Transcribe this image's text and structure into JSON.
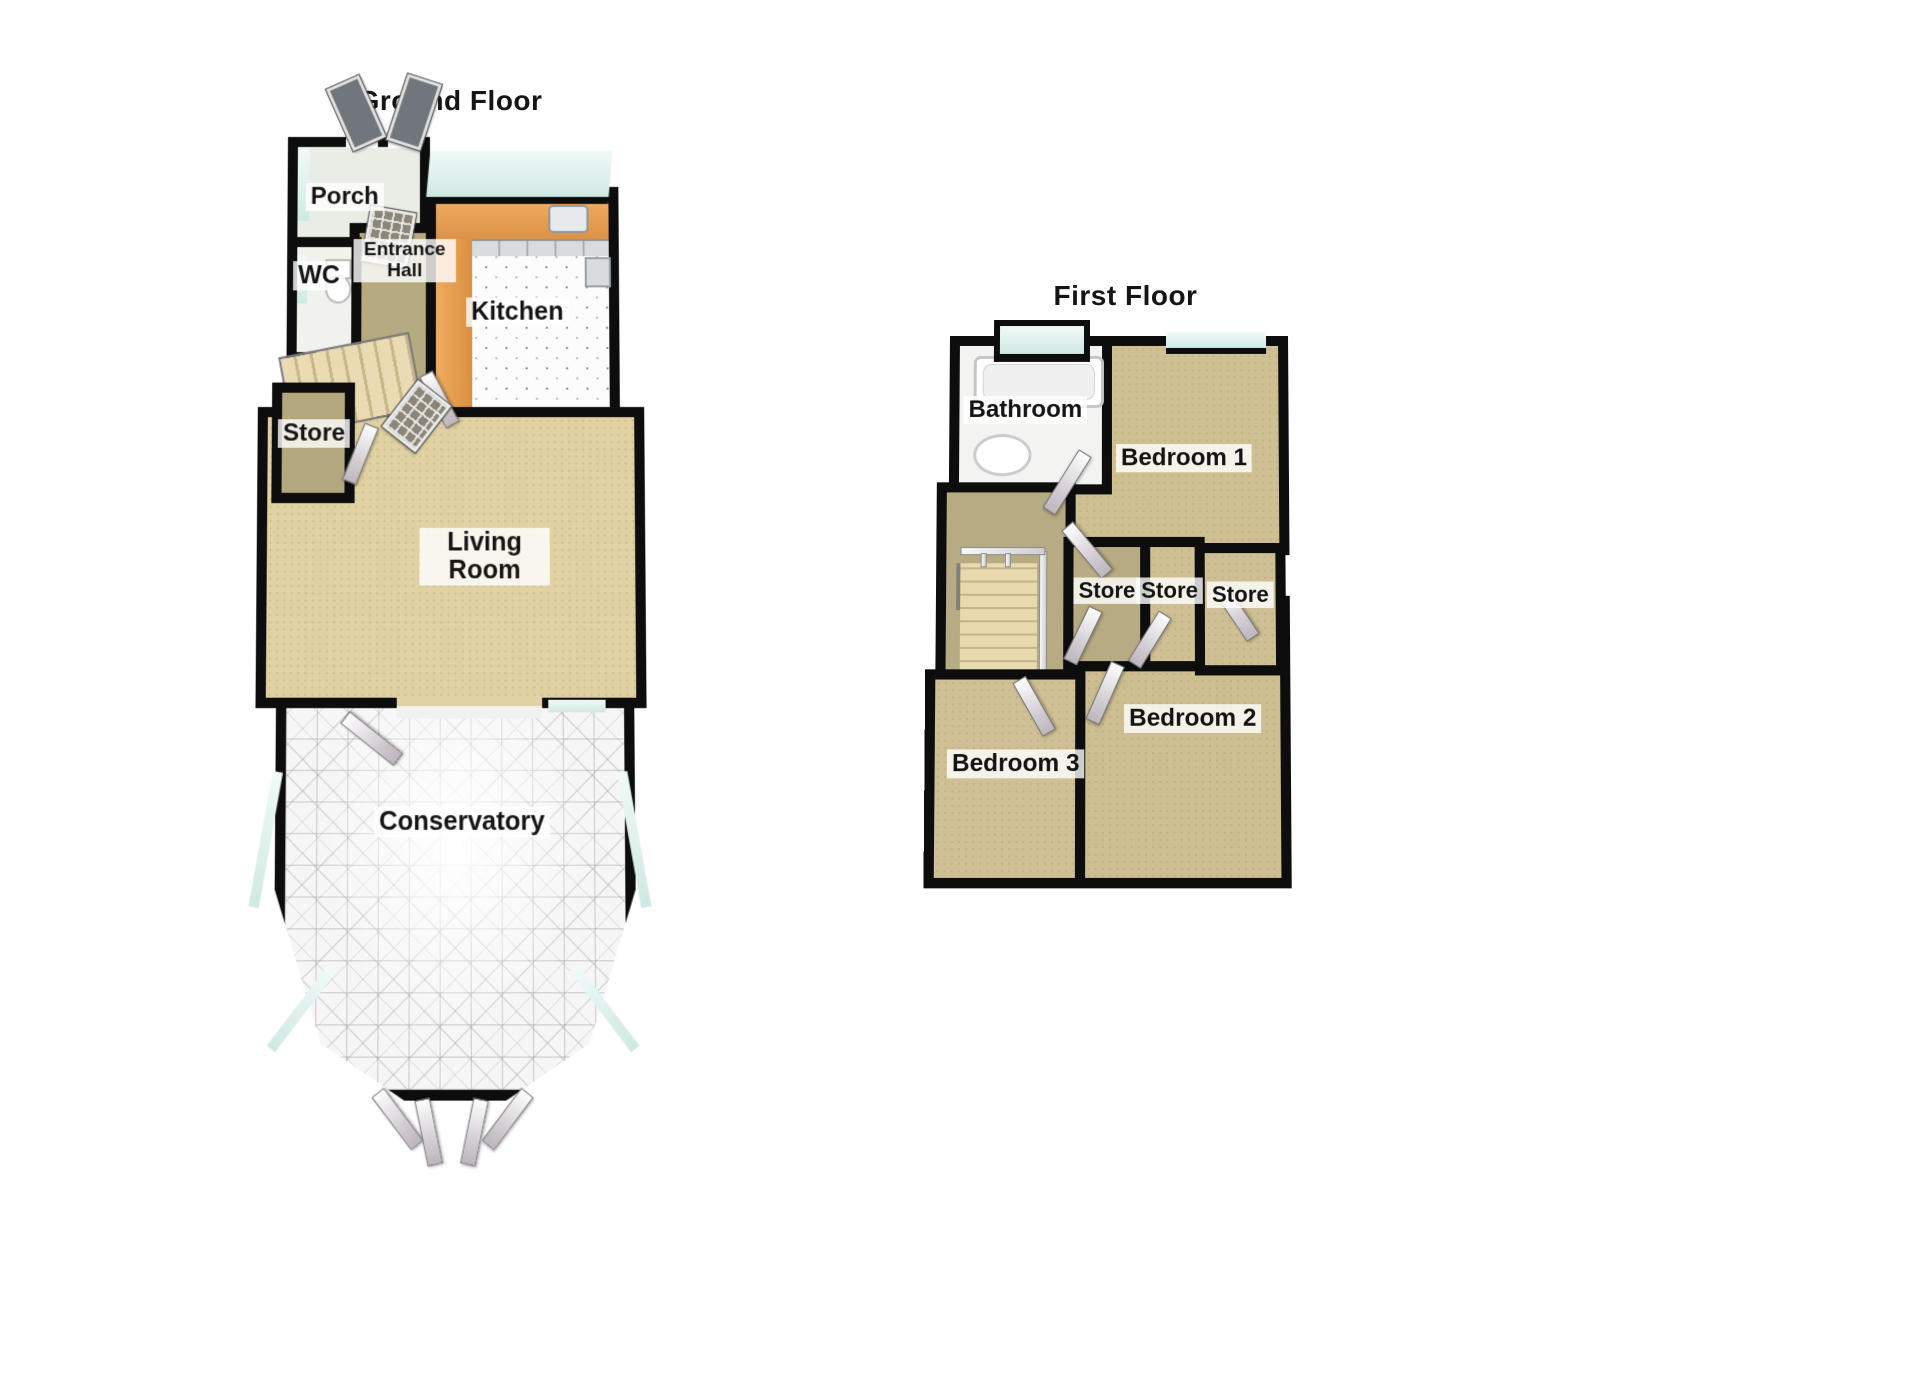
{
  "ground_floor": {
    "title": "Ground Floor",
    "rooms": {
      "porch": {
        "label": "Porch"
      },
      "wc": {
        "label": "WC"
      },
      "entrance_hall": {
        "label": "Entrance Hall"
      },
      "kitchen": {
        "label": "Kitchen"
      },
      "store": {
        "label": "Store"
      },
      "living_room": {
        "label": "Living Room"
      },
      "conservatory": {
        "label": "Conservatory"
      }
    }
  },
  "first_floor": {
    "title": "First Floor",
    "rooms": {
      "bathroom": {
        "label": "Bathroom"
      },
      "bedroom_1": {
        "label": "Bedroom 1"
      },
      "store_1": {
        "label": "Store"
      },
      "store_2": {
        "label": "Store"
      },
      "store_3": {
        "label": "Store"
      },
      "bedroom_2": {
        "label": "Bedroom 2"
      },
      "bedroom_3": {
        "label": "Bedroom 3"
      }
    }
  },
  "colors": {
    "wall_black": "#0d0d0d",
    "living_carpet_tan": "#e1d2a4",
    "hall_carpet_olive": "#b6aa80",
    "bedroom_carpet_tan": "#cfc094",
    "kitchen_counter_orange": "#e9a258",
    "window_glass_teal": "#d6ebe6",
    "conservatory_tile_grey": "#f5f5f5",
    "stairs_beige": "#e8d8ad",
    "fixture_white": "#ffffff"
  }
}
